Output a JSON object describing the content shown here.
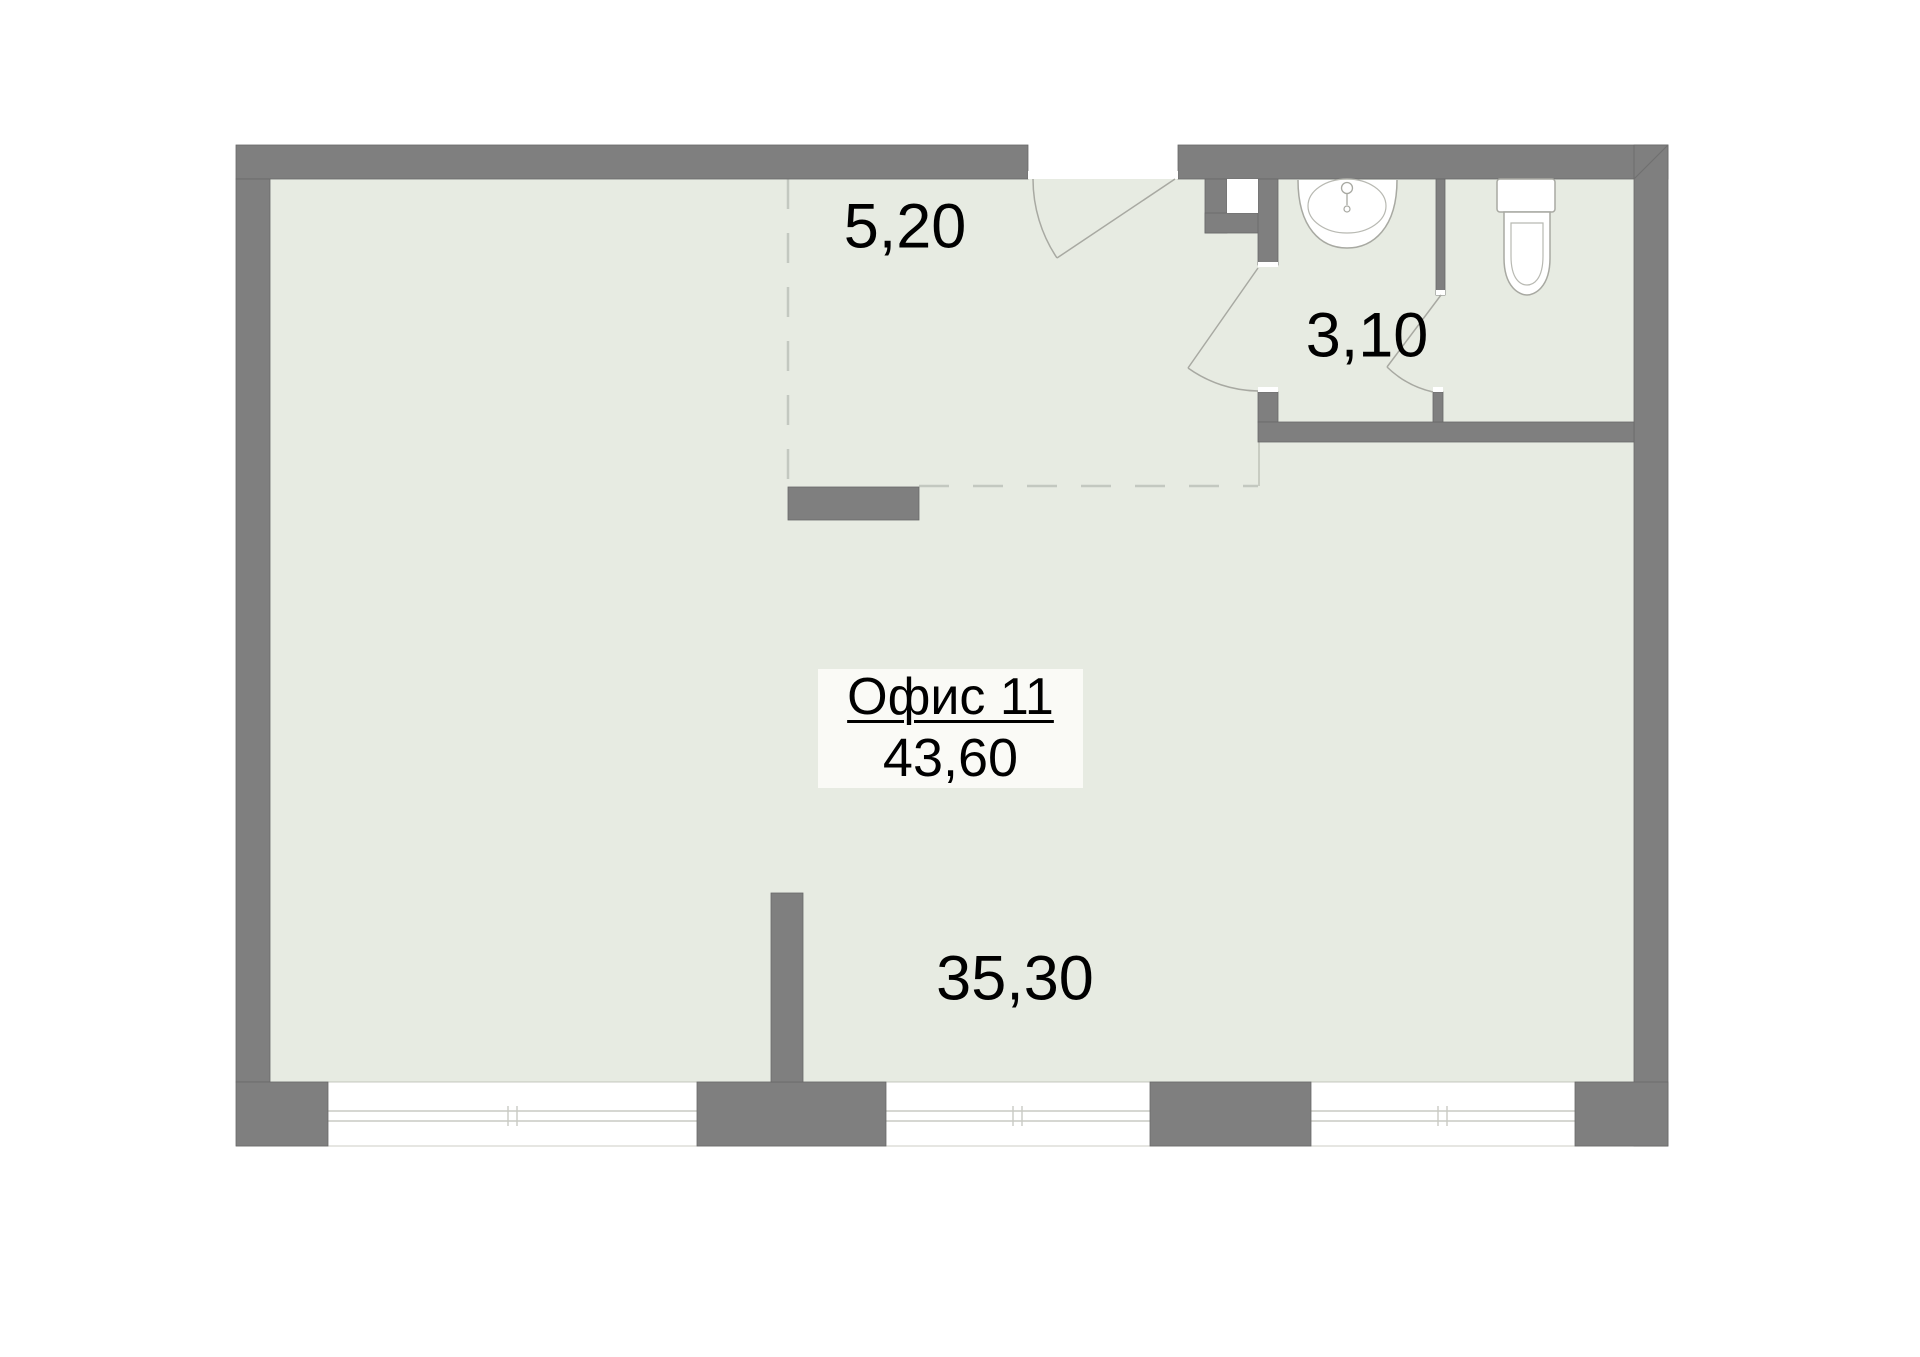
{
  "floor_plan": {
    "office": {
      "title": "Офис 11",
      "total_area": "43,60"
    },
    "rooms": {
      "hall_area": "5,20",
      "bathroom_area": "3,10",
      "main_room_area": "35,30"
    },
    "colors": {
      "wall": "#7f7f7f",
      "wall_edge": "#696969",
      "floor": "#e7ebe2",
      "label_box_bg": "#fafaf6",
      "thin_line": "#a8a9a2",
      "dashed_line": "#c3c8c0",
      "glazing_line": "#c9cac4",
      "text": "#000000"
    }
  }
}
